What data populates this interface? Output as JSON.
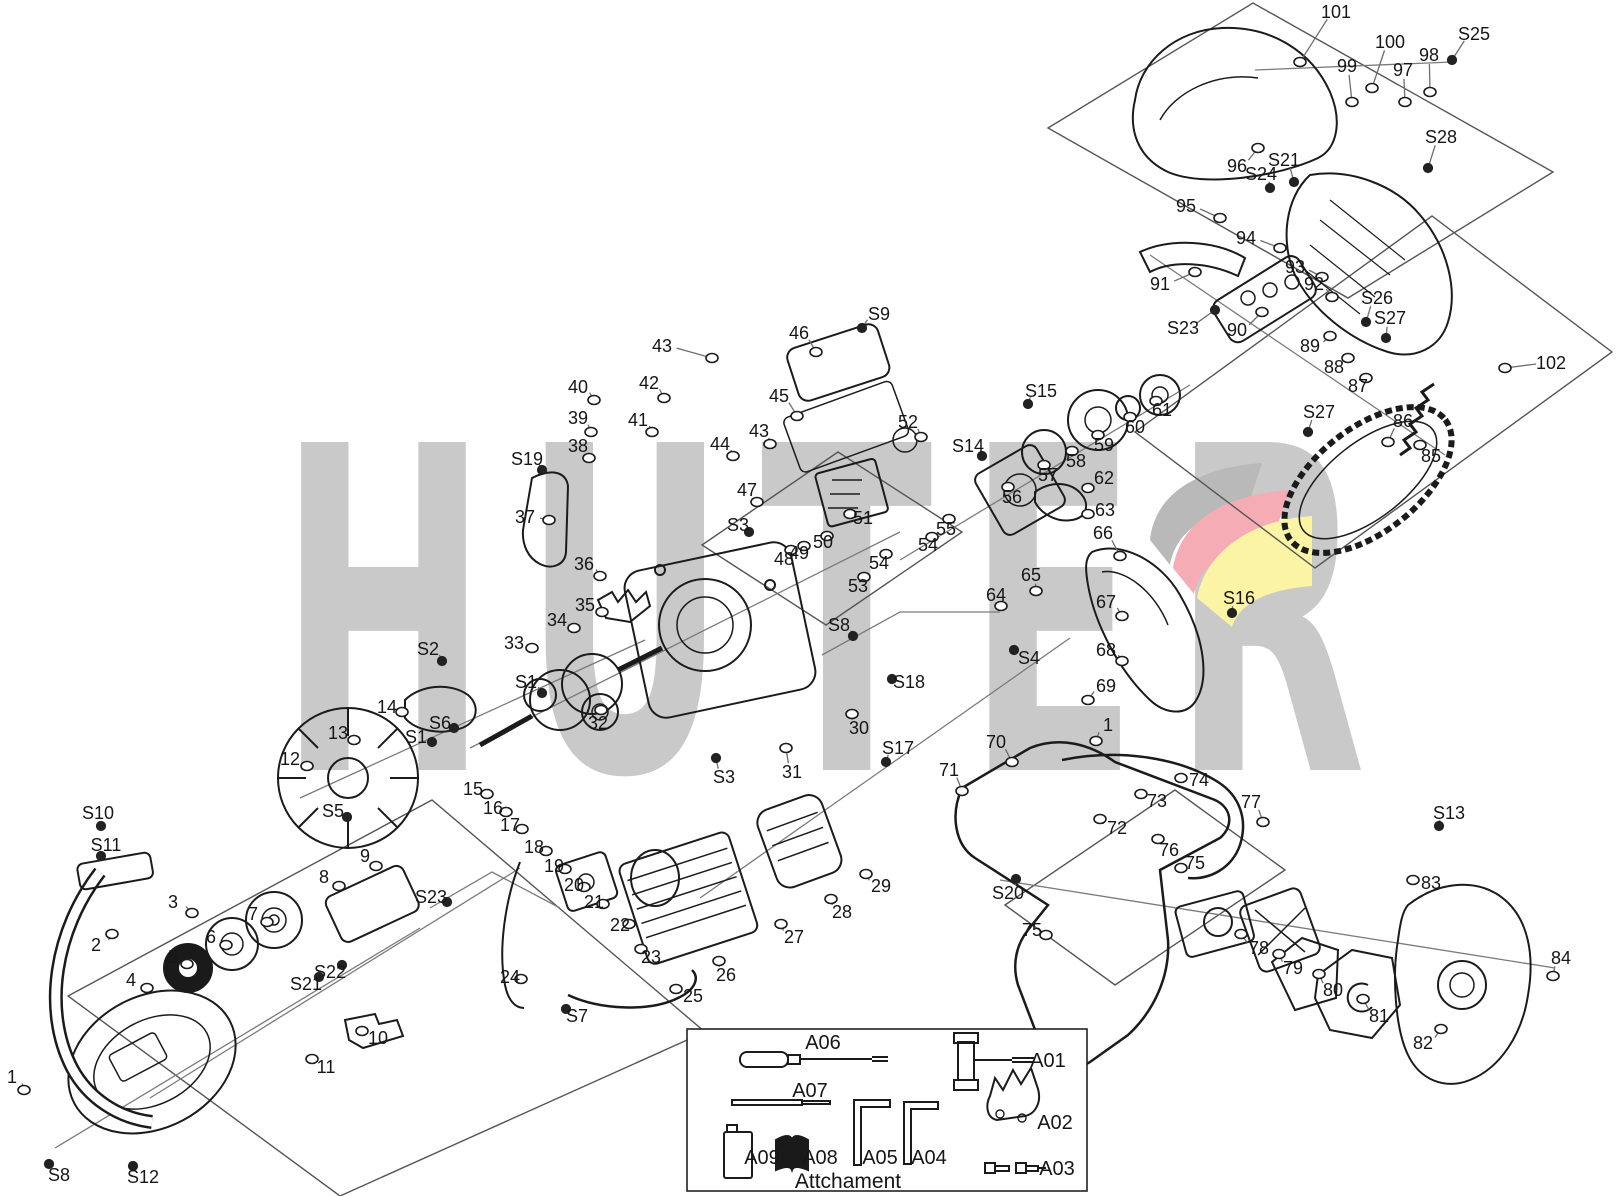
{
  "watermark": {
    "text": "HUTER",
    "letter_color": "#c9c9c9",
    "swoosh_colors": {
      "gray": "#b9b9b9",
      "red": "#f5acb4",
      "yellow": "#fbf4a4"
    }
  },
  "attachment": {
    "title": "Attchament",
    "items": [
      {
        "label": "A06",
        "x": 823,
        "y": 1042
      },
      {
        "label": "A07",
        "x": 810,
        "y": 1090
      },
      {
        "label": "A09",
        "x": 762,
        "y": 1157
      },
      {
        "label": "A08",
        "x": 820,
        "y": 1157
      },
      {
        "label": "A05",
        "x": 880,
        "y": 1157
      },
      {
        "label": "A04",
        "x": 929,
        "y": 1157
      },
      {
        "label": "A01",
        "x": 1048,
        "y": 1060
      },
      {
        "label": "A02",
        "x": 1055,
        "y": 1122
      },
      {
        "label": "A03",
        "x": 1057,
        "y": 1168
      }
    ]
  },
  "labels": [
    {
      "t": "101",
      "x": 1336,
      "y": 12,
      "tx": 1300,
      "ty": 62
    },
    {
      "t": "100",
      "x": 1390,
      "y": 42,
      "tx": 1372,
      "ty": 88
    },
    {
      "t": "99",
      "x": 1347,
      "y": 66,
      "tx": 1352,
      "ty": 102
    },
    {
      "t": "98",
      "x": 1429,
      "y": 55,
      "tx": 1430,
      "ty": 92
    },
    {
      "t": "97",
      "x": 1403,
      "y": 70,
      "tx": 1405,
      "ty": 102
    },
    {
      "t": "S25",
      "x": 1474,
      "y": 34,
      "tx": 1452,
      "ty": 60
    },
    {
      "t": "S28",
      "x": 1441,
      "y": 137,
      "tx": 1428,
      "ty": 168
    },
    {
      "t": "96",
      "x": 1237,
      "y": 166,
      "tx": 1258,
      "ty": 148
    },
    {
      "t": "S24",
      "x": 1261,
      "y": 174,
      "tx": 1270,
      "ty": 188
    },
    {
      "t": "S21",
      "x": 1284,
      "y": 160,
      "tx": 1294,
      "ty": 182
    },
    {
      "t": "95",
      "x": 1186,
      "y": 206,
      "tx": 1220,
      "ty": 218
    },
    {
      "t": "94",
      "x": 1246,
      "y": 238,
      "tx": 1280,
      "ty": 248
    },
    {
      "t": "93",
      "x": 1295,
      "y": 267,
      "tx": 1322,
      "ty": 277
    },
    {
      "t": "92",
      "x": 1314,
      "y": 284,
      "tx": 1332,
      "ty": 297
    },
    {
      "t": "91",
      "x": 1160,
      "y": 284,
      "tx": 1195,
      "ty": 272
    },
    {
      "t": "S23",
      "x": 1183,
      "y": 328,
      "tx": 1215,
      "ty": 310
    },
    {
      "t": "90",
      "x": 1237,
      "y": 330,
      "tx": 1262,
      "ty": 312
    },
    {
      "t": "89",
      "x": 1310,
      "y": 346,
      "tx": 1330,
      "ty": 336
    },
    {
      "t": "S26",
      "x": 1377,
      "y": 298,
      "tx": 1366,
      "ty": 322
    },
    {
      "t": "S27",
      "x": 1390,
      "y": 318,
      "tx": 1386,
      "ty": 338
    },
    {
      "t": "88",
      "x": 1334,
      "y": 367,
      "tx": 1348,
      "ty": 358
    },
    {
      "t": "87",
      "x": 1358,
      "y": 386,
      "tx": 1366,
      "ty": 378
    },
    {
      "t": "S27",
      "x": 1319,
      "y": 412,
      "tx": 1308,
      "ty": 432
    },
    {
      "t": "86",
      "x": 1403,
      "y": 421,
      "tx": 1388,
      "ty": 442
    },
    {
      "t": "85",
      "x": 1431,
      "y": 456,
      "tx": 1420,
      "ty": 445
    },
    {
      "t": "102",
      "x": 1551,
      "y": 363,
      "tx": 1505,
      "ty": 368
    },
    {
      "t": "43",
      "x": 662,
      "y": 346,
      "tx": 712,
      "ty": 358
    },
    {
      "t": "42",
      "x": 649,
      "y": 383,
      "tx": 664,
      "ty": 398
    },
    {
      "t": "41",
      "x": 638,
      "y": 420,
      "tx": 652,
      "ty": 432
    },
    {
      "t": "40",
      "x": 578,
      "y": 387,
      "tx": 594,
      "ty": 400
    },
    {
      "t": "39",
      "x": 578,
      "y": 418,
      "tx": 591,
      "ty": 432
    },
    {
      "t": "38",
      "x": 578,
      "y": 446,
      "tx": 589,
      "ty": 458
    },
    {
      "t": "S19",
      "x": 527,
      "y": 459,
      "tx": 542,
      "ty": 470
    },
    {
      "t": "37",
      "x": 525,
      "y": 517,
      "tx": 549,
      "ty": 520
    },
    {
      "t": "44",
      "x": 720,
      "y": 444,
      "tx": 733,
      "ty": 456
    },
    {
      "t": "43",
      "x": 759,
      "y": 431,
      "tx": 770,
      "ty": 444
    },
    {
      "t": "45",
      "x": 779,
      "y": 396,
      "tx": 797,
      "ty": 416
    },
    {
      "t": "46",
      "x": 799,
      "y": 333,
      "tx": 816,
      "ty": 352
    },
    {
      "t": "S9",
      "x": 879,
      "y": 314,
      "tx": 862,
      "ty": 328
    },
    {
      "t": "47",
      "x": 747,
      "y": 490,
      "tx": 757,
      "ty": 502
    },
    {
      "t": "S3",
      "x": 738,
      "y": 525,
      "tx": 749,
      "ty": 532
    },
    {
      "t": "48",
      "x": 784,
      "y": 559,
      "tx": 791,
      "ty": 550
    },
    {
      "t": "49",
      "x": 799,
      "y": 553,
      "tx": 804,
      "ty": 546
    },
    {
      "t": "50",
      "x": 823,
      "y": 542,
      "tx": 827,
      "ty": 536
    },
    {
      "t": "51",
      "x": 863,
      "y": 518,
      "tx": 850,
      "ty": 514
    },
    {
      "t": "52",
      "x": 908,
      "y": 422,
      "tx": 921,
      "ty": 437
    },
    {
      "t": "S15",
      "x": 1041,
      "y": 391,
      "tx": 1028,
      "ty": 404
    },
    {
      "t": "S14",
      "x": 968,
      "y": 446,
      "tx": 982,
      "ty": 456
    },
    {
      "t": "54",
      "x": 879,
      "y": 563,
      "tx": 886,
      "ty": 554
    },
    {
      "t": "53",
      "x": 858,
      "y": 586,
      "tx": 864,
      "ty": 577
    },
    {
      "t": "54",
      "x": 928,
      "y": 545,
      "tx": 932,
      "ty": 537
    },
    {
      "t": "55",
      "x": 946,
      "y": 529,
      "tx": 949,
      "ty": 519
    },
    {
      "t": "56",
      "x": 1012,
      "y": 497,
      "tx": 1008,
      "ty": 487
    },
    {
      "t": "57",
      "x": 1048,
      "y": 475,
      "tx": 1044,
      "ty": 465
    },
    {
      "t": "58",
      "x": 1076,
      "y": 461,
      "tx": 1072,
      "ty": 451
    },
    {
      "t": "59",
      "x": 1104,
      "y": 445,
      "tx": 1098,
      "ty": 435
    },
    {
      "t": "60",
      "x": 1135,
      "y": 427,
      "tx": 1130,
      "ty": 417
    },
    {
      "t": "61",
      "x": 1162,
      "y": 410,
      "tx": 1156,
      "ty": 401
    },
    {
      "t": "62",
      "x": 1104,
      "y": 478,
      "tx": 1088,
      "ty": 488
    },
    {
      "t": "63",
      "x": 1105,
      "y": 510,
      "tx": 1088,
      "ty": 514
    },
    {
      "t": "66",
      "x": 1103,
      "y": 533,
      "tx": 1120,
      "ty": 556
    },
    {
      "t": "65",
      "x": 1031,
      "y": 575,
      "tx": 1036,
      "ty": 591
    },
    {
      "t": "64",
      "x": 996,
      "y": 595,
      "tx": 1001,
      "ty": 606
    },
    {
      "t": "67",
      "x": 1106,
      "y": 602,
      "tx": 1122,
      "ty": 616
    },
    {
      "t": "68",
      "x": 1106,
      "y": 650,
      "tx": 1122,
      "ty": 661
    },
    {
      "t": "69",
      "x": 1106,
      "y": 686,
      "tx": 1088,
      "ty": 700
    },
    {
      "t": "S16",
      "x": 1239,
      "y": 598,
      "tx": 1232,
      "ty": 613
    },
    {
      "t": "S4",
      "x": 1029,
      "y": 658,
      "tx": 1014,
      "ty": 650
    },
    {
      "t": "S8",
      "x": 839,
      "y": 625,
      "tx": 853,
      "ty": 636
    },
    {
      "t": "S18",
      "x": 909,
      "y": 682,
      "tx": 892,
      "ty": 679
    },
    {
      "t": "30",
      "x": 859,
      "y": 728,
      "tx": 852,
      "ty": 714
    },
    {
      "t": "31",
      "x": 792,
      "y": 772,
      "tx": 786,
      "ty": 748
    },
    {
      "t": "S3",
      "x": 724,
      "y": 777,
      "tx": 716,
      "ty": 758
    },
    {
      "t": "S17",
      "x": 898,
      "y": 748,
      "tx": 886,
      "ty": 762
    },
    {
      "t": "36",
      "x": 584,
      "y": 564,
      "tx": 600,
      "ty": 576
    },
    {
      "t": "35",
      "x": 585,
      "y": 605,
      "tx": 602,
      "ty": 612
    },
    {
      "t": "34",
      "x": 557,
      "y": 620,
      "tx": 574,
      "ty": 628
    },
    {
      "t": "33",
      "x": 514,
      "y": 643,
      "tx": 532,
      "ty": 648
    },
    {
      "t": "S2",
      "x": 428,
      "y": 649,
      "tx": 442,
      "ty": 661
    },
    {
      "t": "S1",
      "x": 526,
      "y": 682,
      "tx": 542,
      "ty": 693
    },
    {
      "t": "32",
      "x": 598,
      "y": 723,
      "tx": 601,
      "ty": 710
    },
    {
      "t": "14",
      "x": 387,
      "y": 707,
      "tx": 402,
      "ty": 712
    },
    {
      "t": "S6",
      "x": 440,
      "y": 723,
      "tx": 454,
      "ty": 728
    },
    {
      "t": "S1",
      "x": 416,
      "y": 737,
      "tx": 432,
      "ty": 742
    },
    {
      "t": "13",
      "x": 338,
      "y": 733,
      "tx": 354,
      "ty": 740
    },
    {
      "t": "12",
      "x": 290,
      "y": 759,
      "tx": 307,
      "ty": 766
    },
    {
      "t": "S5",
      "x": 333,
      "y": 811,
      "tx": 347,
      "ty": 817
    },
    {
      "t": "15",
      "x": 473,
      "y": 789,
      "tx": 487,
      "ty": 794
    },
    {
      "t": "16",
      "x": 493,
      "y": 808,
      "tx": 506,
      "ty": 812
    },
    {
      "t": "17",
      "x": 510,
      "y": 825,
      "tx": 522,
      "ty": 829
    },
    {
      "t": "18",
      "x": 534,
      "y": 847,
      "tx": 546,
      "ty": 851
    },
    {
      "t": "19",
      "x": 554,
      "y": 866,
      "tx": 565,
      "ty": 869
    },
    {
      "t": "20",
      "x": 574,
      "y": 885,
      "tx": 584,
      "ty": 887
    },
    {
      "t": "21",
      "x": 594,
      "y": 902,
      "tx": 603,
      "ty": 904
    },
    {
      "t": "22",
      "x": 620,
      "y": 925,
      "tx": 629,
      "ty": 924
    },
    {
      "t": "23",
      "x": 651,
      "y": 957,
      "tx": 641,
      "ty": 949
    },
    {
      "t": "S23",
      "x": 431,
      "y": 897,
      "tx": 447,
      "ty": 902
    },
    {
      "t": "S22",
      "x": 330,
      "y": 972,
      "tx": 342,
      "ty": 965
    },
    {
      "t": "S21",
      "x": 306,
      "y": 984,
      "tx": 319,
      "ty": 977
    },
    {
      "t": "24",
      "x": 510,
      "y": 977,
      "tx": 521,
      "ty": 979
    },
    {
      "t": "S7",
      "x": 577,
      "y": 1016,
      "tx": 566,
      "ty": 1009
    },
    {
      "t": "25",
      "x": 693,
      "y": 996,
      "tx": 676,
      "ty": 989
    },
    {
      "t": "26",
      "x": 726,
      "y": 975,
      "tx": 719,
      "ty": 961
    },
    {
      "t": "27",
      "x": 794,
      "y": 937,
      "tx": 781,
      "ty": 924
    },
    {
      "t": "28",
      "x": 842,
      "y": 912,
      "tx": 831,
      "ty": 899
    },
    {
      "t": "29",
      "x": 881,
      "y": 886,
      "tx": 866,
      "ty": 874
    },
    {
      "t": "S10",
      "x": 98,
      "y": 813,
      "tx": 101,
      "ty": 826
    },
    {
      "t": "S11",
      "x": 106,
      "y": 845,
      "tx": 101,
      "ty": 856
    },
    {
      "t": "2",
      "x": 96,
      "y": 945,
      "tx": 112,
      "ty": 934
    },
    {
      "t": "3",
      "x": 173,
      "y": 902,
      "tx": 192,
      "ty": 913
    },
    {
      "t": "9",
      "x": 365,
      "y": 856,
      "tx": 376,
      "ty": 866
    },
    {
      "t": "8",
      "x": 324,
      "y": 877,
      "tx": 339,
      "ty": 886
    },
    {
      "t": "7",
      "x": 253,
      "y": 914,
      "tx": 267,
      "ty": 922
    },
    {
      "t": "6",
      "x": 211,
      "y": 937,
      "tx": 226,
      "ty": 945
    },
    {
      "t": "5",
      "x": 173,
      "y": 957,
      "tx": 187,
      "ty": 964
    },
    {
      "t": "4",
      "x": 131,
      "y": 980,
      "tx": 147,
      "ty": 988
    },
    {
      "t": "10",
      "x": 378,
      "y": 1038,
      "tx": 362,
      "ty": 1031
    },
    {
      "t": "11",
      "x": 326,
      "y": 1067,
      "tx": 312,
      "ty": 1059
    },
    {
      "t": "1",
      "x": 12,
      "y": 1077,
      "tx": 24,
      "ty": 1090
    },
    {
      "t": "S8",
      "x": 59,
      "y": 1175,
      "tx": 49,
      "ty": 1164
    },
    {
      "t": "S12",
      "x": 143,
      "y": 1177,
      "tx": 133,
      "ty": 1166
    },
    {
      "t": "S20",
      "x": 1008,
      "y": 893,
      "tx": 1016,
      "ty": 879
    },
    {
      "t": "70",
      "x": 996,
      "y": 742,
      "tx": 1012,
      "ty": 762
    },
    {
      "t": "71",
      "x": 949,
      "y": 770,
      "tx": 962,
      "ty": 791
    },
    {
      "t": "72",
      "x": 1117,
      "y": 828,
      "tx": 1100,
      "ty": 819
    },
    {
      "t": "73",
      "x": 1157,
      "y": 801,
      "tx": 1141,
      "ty": 794
    },
    {
      "t": "74",
      "x": 1199,
      "y": 780,
      "tx": 1181,
      "ty": 778
    },
    {
      "t": "76",
      "x": 1169,
      "y": 850,
      "tx": 1158,
      "ty": 839
    },
    {
      "t": "75",
      "x": 1195,
      "y": 863,
      "tx": 1181,
      "ty": 868
    },
    {
      "t": "75",
      "x": 1032,
      "y": 930,
      "tx": 1046,
      "ty": 935
    },
    {
      "t": "77",
      "x": 1251,
      "y": 802,
      "tx": 1263,
      "ty": 822
    },
    {
      "t": "78",
      "x": 1259,
      "y": 948,
      "tx": 1241,
      "ty": 934
    },
    {
      "t": "79",
      "x": 1293,
      "y": 968,
      "tx": 1279,
      "ty": 954
    },
    {
      "t": "80",
      "x": 1333,
      "y": 990,
      "tx": 1319,
      "ty": 974
    },
    {
      "t": "81",
      "x": 1379,
      "y": 1016,
      "tx": 1363,
      "ty": 999
    },
    {
      "t": "82",
      "x": 1423,
      "y": 1043,
      "tx": 1441,
      "ty": 1029
    },
    {
      "t": "83",
      "x": 1431,
      "y": 883,
      "tx": 1413,
      "ty": 880
    },
    {
      "t": "S13",
      "x": 1449,
      "y": 813,
      "tx": 1439,
      "ty": 826
    },
    {
      "t": "84",
      "x": 1561,
      "y": 958,
      "tx": 1553,
      "ty": 976
    },
    {
      "t": "1",
      "x": 1108,
      "y": 725,
      "tx": 1096,
      "ty": 741
    }
  ]
}
